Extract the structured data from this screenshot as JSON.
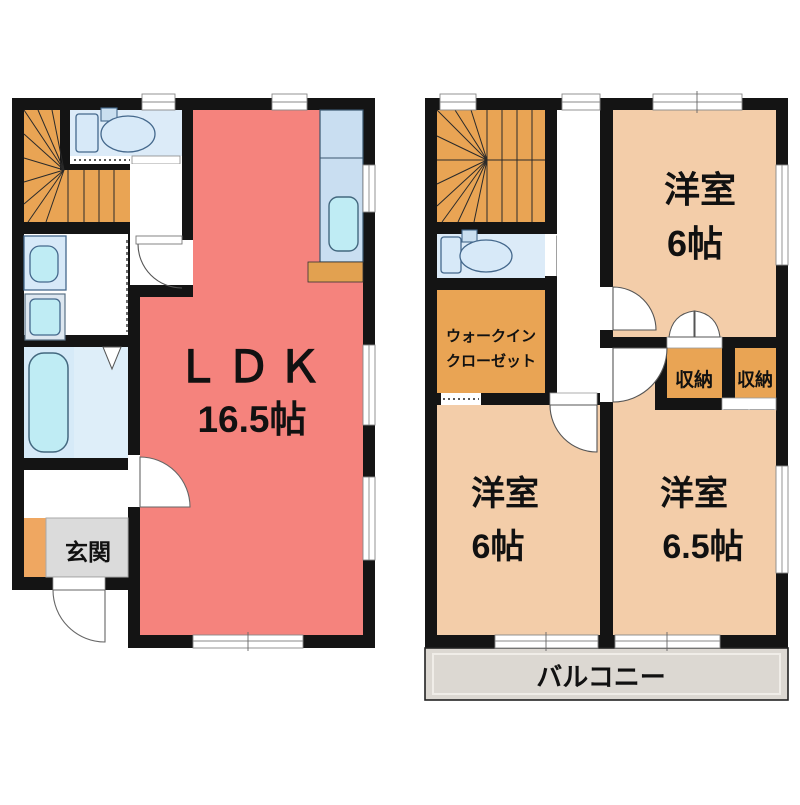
{
  "palette": {
    "wall": "#141414",
    "ldk_pink": "#F5837D",
    "room_peach": "#F3CDA9",
    "stair_orange": "#E9A454",
    "storage_orange": "#E9A454",
    "water_floor_blue": "#DCEBF8",
    "bath_floor_blue": "#D6EAF8",
    "fixture_cyan": "#BFECF4",
    "kitchen_counter_blue": "#C9DEF1",
    "entrance_gray": "#DBDBDB",
    "entrance_step_orange": "#EFA761",
    "balcony_gray": "#DCD8D2"
  },
  "floor1": {
    "ldk": {
      "label": "ＬＤＫ",
      "area": "16.5帖"
    },
    "entrance": {
      "label": "玄関"
    }
  },
  "floor2": {
    "room_top_right": {
      "label": "洋室",
      "area": "6帖"
    },
    "room_bottom_left": {
      "label": "洋室",
      "area": "6帖"
    },
    "room_bottom_right": {
      "label": "洋室",
      "area": "6.5帖"
    },
    "walk_in_closet": {
      "label_line1": "ウォークイン",
      "label_line2": "クローゼット"
    },
    "storage_left": {
      "label": "収納"
    },
    "storage_right": {
      "label": "収納"
    },
    "balcony": {
      "label": "バルコニー"
    }
  }
}
